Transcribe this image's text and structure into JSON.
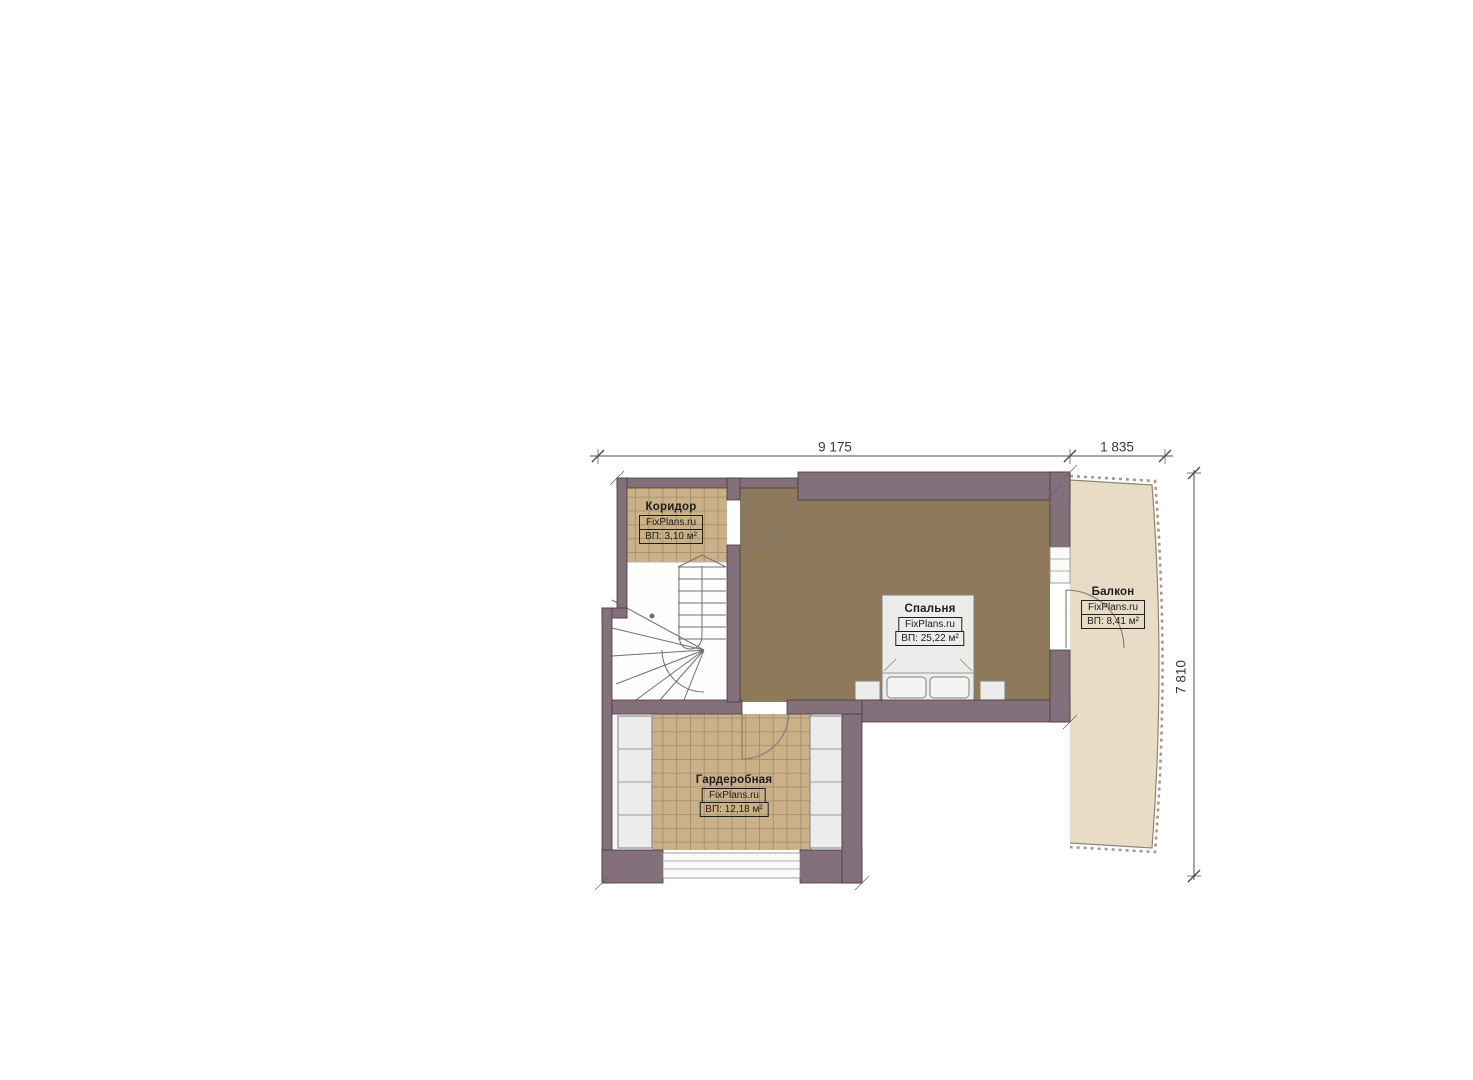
{
  "plan": {
    "rooms": [
      {
        "id": "corridor",
        "name": "Коридор",
        "watermark": "FixPlans.ru",
        "area": "ВП: 3,10 м²"
      },
      {
        "id": "bedroom",
        "name": "Спальня",
        "watermark": "FixPlans.ru",
        "area": "ВП: 25,22 м²"
      },
      {
        "id": "balcony",
        "name": "Балкон",
        "watermark": "FixPlans.ru",
        "area": "ВП: 8,41 м²"
      },
      {
        "id": "wardrobe",
        "name": "Гардеробная",
        "watermark": "FixPlans.ru",
        "area": "ВП: 12,18 м²"
      }
    ],
    "dimensions": {
      "top_left": "9 175",
      "top_right": "1 835",
      "right": "7 810"
    },
    "colors": {
      "wall": "#83707b",
      "wall_line": "#443a41",
      "bedroom_floor": "#8e7a5b",
      "tile_floor": "#cbb188",
      "tile_line": "#9d8a6c",
      "balcony_floor": "#e9dcc6",
      "railing": "#8f8474",
      "furniture": "#ececea",
      "furniture_line": "#818181",
      "stair_line": "#707070",
      "door_line": "#7b7b7b",
      "dimension": "#4c4c4c",
      "text": "#1c1c1c"
    }
  }
}
